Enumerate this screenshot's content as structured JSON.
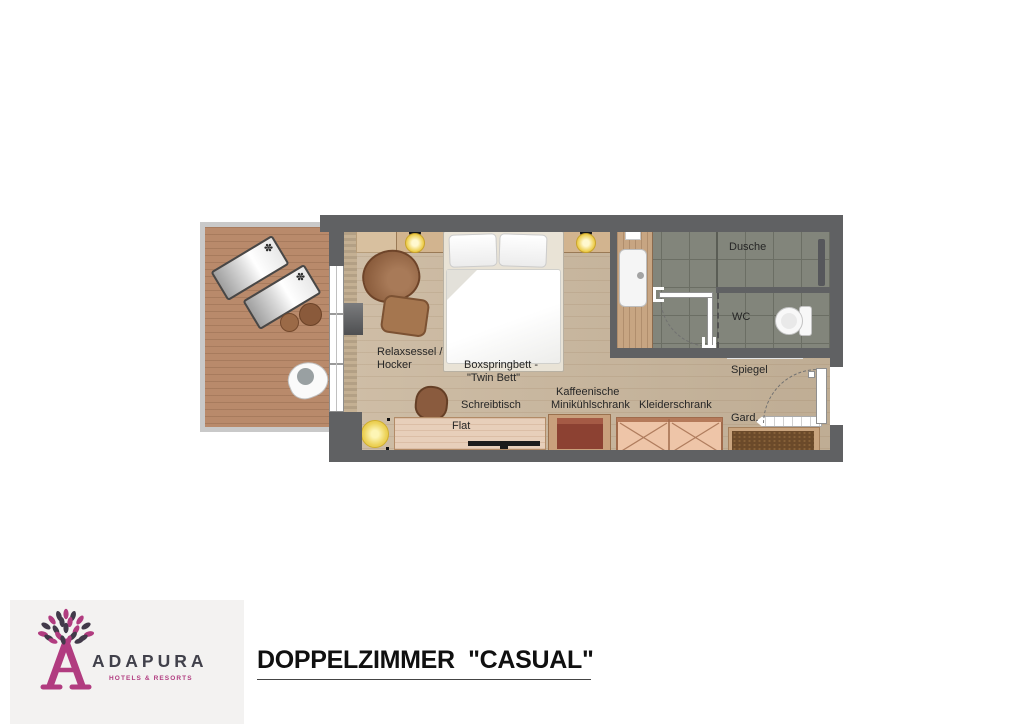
{
  "brand": {
    "name": "ADAPURA",
    "tagline": "HOTELS & RESORTS",
    "colors": {
      "magenta": "#b13c80",
      "charcoal": "#41414b",
      "logo_background": "#f3f2f1"
    }
  },
  "title": {
    "text": "DOPPELZIMMER  \"CASUAL\""
  },
  "floorplan": {
    "labels": {
      "relax1": "Relaxsessel /",
      "relax2": "Hocker",
      "bed1": "Boxspringbett -",
      "bed2": "\"Twin Bett\"",
      "desk": "Schreibtisch",
      "tv": "Flat",
      "coffee1": "Kaffeenische",
      "coffee2": "Minikühlschrank",
      "wardrobe": "Kleiderschrank",
      "garderobe": "Gard.",
      "mirror": "Spiegel",
      "shower": "Dusche",
      "wc": "WC"
    },
    "icons": {
      "lounger_flower": "✽"
    },
    "colors": {
      "wall": "#606163",
      "terrace_deck": "#b98a6b",
      "room_floor": "#c9b69c",
      "bathroom_tile": "#82857b",
      "headboard": "#5f4231",
      "minibar": "#8c4132",
      "wardrobe": "#eec5a8",
      "lamp_glow": "#eecf52"
    }
  }
}
